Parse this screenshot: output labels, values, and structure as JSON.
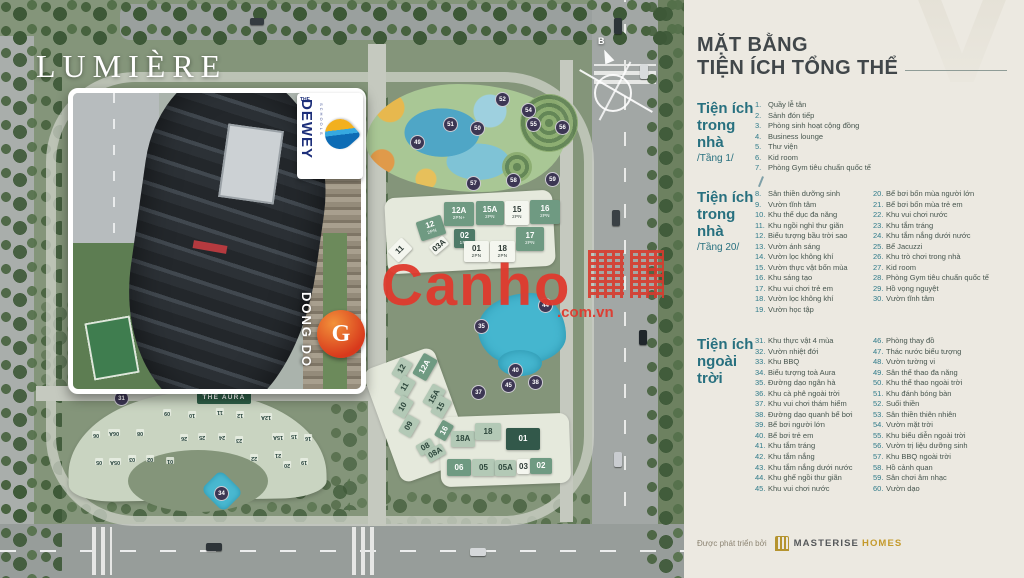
{
  "project": {
    "name": "LUMIÈRE",
    "aura_label": "THE AURA",
    "compass_north": "B"
  },
  "watermark": {
    "word": "Canho",
    "suffix": ".com.vn"
  },
  "inset": {
    "dewey_the": "THE",
    "dewey_word": "DEWEY",
    "dewey_sub": "SCHOOLS",
    "dongdo_word": "DONG DO",
    "dongdo_letter": "G"
  },
  "colors": {
    "accent_teal": "#27707F",
    "legend_text": "#47564F",
    "masterise_gold": "#C49A2C",
    "watermark_red": "#E03A2E",
    "marker_bg": "#3C3653"
  },
  "panel": {
    "title_line1": "MẶT BẰNG",
    "title_line2": "TIỆN ÍCH TỔNG THỂ"
  },
  "legend": {
    "s1": {
      "header": [
        "Tiện ích",
        "trong nhà",
        "/Tầng 1/"
      ],
      "items": [
        {
          "n": "1.",
          "t": "Quầy lễ tân"
        },
        {
          "n": "2.",
          "t": "Sảnh đón tiếp"
        },
        {
          "n": "3.",
          "t": "Phòng sinh hoạt cộng đồng"
        },
        {
          "n": "4.",
          "t": "Business lounge"
        },
        {
          "n": "5.",
          "t": "Thư viện"
        },
        {
          "n": "6.",
          "t": "Kid room"
        },
        {
          "n": "7.",
          "t": "Phòng Gym tiêu chuẩn quốc tế"
        }
      ]
    },
    "s2": {
      "header": [
        "Tiện ích",
        "trong nhà",
        "/Tầng 20/"
      ],
      "colA": [
        {
          "n": "8.",
          "t": "Sân thiền dưỡng sinh"
        },
        {
          "n": "9.",
          "t": "Vườn tĩnh tâm"
        },
        {
          "n": "10.",
          "t": "Khu thể dục đa năng"
        },
        {
          "n": "11.",
          "t": "Khu ngồi nghỉ thư giãn"
        },
        {
          "n": "12.",
          "t": "Biểu tượng bầu trời sao"
        },
        {
          "n": "13.",
          "t": "Vườn ánh sáng"
        },
        {
          "n": "14.",
          "t": "Vườn lọc không khí"
        },
        {
          "n": "15.",
          "t": "Vườn thực vật bốn mùa"
        },
        {
          "n": "16.",
          "t": "Khu sáng tạo"
        },
        {
          "n": "17.",
          "t": "Khu vui chơi trẻ em"
        },
        {
          "n": "18.",
          "t": "Vườn lọc không khí"
        },
        {
          "n": "19.",
          "t": "Vườn học tập"
        }
      ],
      "colB": [
        {
          "n": "20.",
          "t": "Bể bơi bốn mùa người lớn"
        },
        {
          "n": "21.",
          "t": "Bể bơi bốn mùa trẻ em"
        },
        {
          "n": "22.",
          "t": "Khu vui chơi nước"
        },
        {
          "n": "23.",
          "t": "Khu tắm tráng"
        },
        {
          "n": "24.",
          "t": "Khu tắm nắng dưới nước"
        },
        {
          "n": "25.",
          "t": "Bể Jacuzzi"
        },
        {
          "n": "26.",
          "t": "Khu trò chơi trong nhà"
        },
        {
          "n": "27.",
          "t": "Kid room"
        },
        {
          "n": "28.",
          "t": "Phòng Gym tiêu chuẩn quốc tế"
        },
        {
          "n": "29.",
          "t": "Hồ vọng nguyệt"
        },
        {
          "n": "30.",
          "t": "Vườn tĩnh tâm"
        }
      ]
    },
    "s3": {
      "header": [
        "Tiện ích",
        "ngoài trời"
      ],
      "colA": [
        {
          "n": "31.",
          "t": "Khu thực vật 4 mùa"
        },
        {
          "n": "32.",
          "t": "Vườn nhiệt đới"
        },
        {
          "n": "33.",
          "t": "Khu BBQ"
        },
        {
          "n": "34.",
          "t": "Biểu tượng toà Aura"
        },
        {
          "n": "35.",
          "t": "Đường dạo ngân hà"
        },
        {
          "n": "36.",
          "t": "Khu cà phê ngoài trời"
        },
        {
          "n": "37.",
          "t": "Khu vui chơi thám hiểm"
        },
        {
          "n": "38.",
          "t": "Đường dạo quanh bể bơi"
        },
        {
          "n": "39.",
          "t": "Bể bơi người lớn"
        },
        {
          "n": "40.",
          "t": "Bể bơi trẻ em"
        },
        {
          "n": "41.",
          "t": "Khu tắm tráng"
        },
        {
          "n": "42.",
          "t": "Khu tắm nắng"
        },
        {
          "n": "43.",
          "t": "Khu tắm nắng dưới nước"
        },
        {
          "n": "44.",
          "t": "Khu ghế ngồi thư giãn"
        },
        {
          "n": "45.",
          "t": "Khu vui chơi nước"
        }
      ],
      "colB": [
        {
          "n": "46.",
          "t": "Phòng thay đồ"
        },
        {
          "n": "47.",
          "t": "Thác nước biểu tượng"
        },
        {
          "n": "48.",
          "t": "Vườn tường vi"
        },
        {
          "n": "49.",
          "t": "Sân thể thao đa năng"
        },
        {
          "n": "50.",
          "t": "Khu thể thao ngoài trời"
        },
        {
          "n": "51.",
          "t": "Khu đánh bóng bàn"
        },
        {
          "n": "52.",
          "t": "Suối thiền"
        },
        {
          "n": "53.",
          "t": "Sân thiền thiên nhiên"
        },
        {
          "n": "54.",
          "t": "Vườn mặt trời"
        },
        {
          "n": "55.",
          "t": "Khu biểu diễn ngoài trời"
        },
        {
          "n": "56.",
          "t": "Vườn trị liệu dưỡng sinh"
        },
        {
          "n": "57.",
          "t": "Khu BBQ ngoài trời"
        },
        {
          "n": "58.",
          "t": "Hồ cảnh quan"
        },
        {
          "n": "59.",
          "t": "Sân chơi âm nhạc"
        },
        {
          "n": "60.",
          "t": "Vườn dạo"
        }
      ]
    }
  },
  "footer": {
    "prefix": "Được phát triển bởi",
    "brand": "MASTERISE",
    "brand2": "HOMES"
  },
  "map": {
    "north_blocks": [
      {
        "t": "12",
        "s": "2PN",
        "x": 418,
        "y": 218,
        "w": 26,
        "h": 20,
        "r": -18,
        "cls": "g1"
      },
      {
        "t": "12A",
        "s": "2PN+",
        "x": 444,
        "y": 202,
        "w": 30,
        "h": 24,
        "cls": "g1"
      },
      {
        "t": "15A",
        "s": "2PN",
        "x": 476,
        "y": 201,
        "w": 28,
        "h": 24,
        "cls": "g1"
      },
      {
        "t": "15",
        "s": "2PN",
        "x": 505,
        "y": 201,
        "w": 24,
        "h": 24,
        "cls": "w"
      },
      {
        "t": "16",
        "s": "2PN",
        "x": 530,
        "y": 200,
        "w": 30,
        "h": 24,
        "cls": "g1"
      },
      {
        "t": "11",
        "s": "",
        "x": 390,
        "y": 242,
        "w": 20,
        "h": 16,
        "r": -45,
        "cls": "w"
      },
      {
        "t": "03A",
        "s": "",
        "x": 430,
        "y": 240,
        "w": 18,
        "h": 11,
        "r": -40,
        "cls": "w"
      },
      {
        "t": "02",
        "s": "1PN",
        "x": 454,
        "y": 229,
        "w": 21,
        "h": 19,
        "cls": "g3"
      },
      {
        "t": "01",
        "s": "2PN",
        "x": 464,
        "y": 241,
        "w": 25,
        "h": 21,
        "cls": "w"
      },
      {
        "t": "18",
        "s": "2PN",
        "x": 490,
        "y": 241,
        "w": 25,
        "h": 21,
        "cls": "w"
      },
      {
        "t": "17",
        "s": "2PN",
        "x": 516,
        "y": 227,
        "w": 28,
        "h": 24,
        "cls": "g1"
      }
    ],
    "south_blocks": [
      {
        "t": "12",
        "x": 392,
        "y": 362,
        "w": 20,
        "h": 14,
        "r": -60,
        "cls": "g2"
      },
      {
        "t": "12A",
        "x": 413,
        "y": 359,
        "w": 24,
        "h": 16,
        "r": -60,
        "cls": "g1"
      },
      {
        "t": "11",
        "x": 395,
        "y": 380,
        "w": 20,
        "h": 14,
        "r": -60,
        "cls": "g2"
      },
      {
        "t": "15A",
        "x": 423,
        "y": 389,
        "w": 22,
        "h": 15,
        "r": -60,
        "cls": "g2"
      },
      {
        "t": "15",
        "x": 431,
        "y": 400,
        "w": 20,
        "h": 14,
        "r": -60,
        "cls": "g2"
      },
      {
        "t": "10",
        "x": 393,
        "y": 400,
        "w": 20,
        "h": 14,
        "r": -60,
        "cls": "g2"
      },
      {
        "t": "09",
        "x": 399,
        "y": 419,
        "w": 20,
        "h": 14,
        "r": -60,
        "cls": "g2"
      },
      {
        "t": "16",
        "x": 435,
        "y": 424,
        "w": 18,
        "h": 13,
        "r": -60,
        "cls": "g1"
      },
      {
        "t": "18A",
        "x": 451,
        "y": 431,
        "w": 24,
        "h": 16,
        "cls": "g2"
      },
      {
        "t": "18",
        "x": 475,
        "y": 423,
        "w": 26,
        "h": 17,
        "cls": "g2"
      },
      {
        "t": "01",
        "x": 506,
        "y": 428,
        "w": 34,
        "h": 22,
        "cls": "d"
      },
      {
        "t": "08",
        "x": 417,
        "y": 441,
        "w": 17,
        "h": 12,
        "r": -30,
        "cls": "g2"
      },
      {
        "t": "08A",
        "x": 426,
        "y": 447,
        "w": 19,
        "h": 12,
        "r": -30,
        "cls": "g2"
      },
      {
        "t": "06",
        "x": 447,
        "y": 459,
        "w": 24,
        "h": 17,
        "cls": "g1"
      },
      {
        "t": "05",
        "x": 472,
        "y": 459,
        "w": 23,
        "h": 17,
        "cls": "g2"
      },
      {
        "t": "05A",
        "x": 495,
        "y": 460,
        "w": 21,
        "h": 16,
        "cls": "g2"
      },
      {
        "t": "03",
        "x": 517,
        "y": 459,
        "w": 13,
        "h": 15,
        "cls": "w"
      },
      {
        "t": "02",
        "x": 530,
        "y": 458,
        "w": 22,
        "h": 16,
        "cls": "g1"
      }
    ],
    "aura_units": [
      {
        "t": "09",
        "x": 163,
        "y": 409,
        "r": 180
      },
      {
        "t": "10",
        "x": 188,
        "y": 411,
        "r": 180
      },
      {
        "t": "11",
        "x": 216,
        "y": 408,
        "r": 180
      },
      {
        "t": "12",
        "x": 236,
        "y": 411,
        "r": 180
      },
      {
        "t": "12A",
        "x": 260,
        "y": 413,
        "r": 180
      },
      {
        "t": "06",
        "x": 92,
        "y": 431,
        "r": 180
      },
      {
        "t": "06A",
        "x": 108,
        "y": 429,
        "r": 180
      },
      {
        "t": "08",
        "x": 136,
        "y": 429,
        "r": 180
      },
      {
        "t": "26",
        "x": 180,
        "y": 434,
        "r": 180
      },
      {
        "t": "25",
        "x": 198,
        "y": 433,
        "r": 180
      },
      {
        "t": "24",
        "x": 218,
        "y": 433,
        "r": 180
      },
      {
        "t": "23",
        "x": 235,
        "y": 436,
        "r": 180
      },
      {
        "t": "15A",
        "x": 272,
        "y": 433,
        "r": 180
      },
      {
        "t": "15",
        "x": 290,
        "y": 432,
        "r": 180
      },
      {
        "t": "16",
        "x": 304,
        "y": 434,
        "r": 180
      },
      {
        "t": "05",
        "x": 95,
        "y": 458,
        "r": 180
      },
      {
        "t": "05A",
        "x": 109,
        "y": 458,
        "r": 180
      },
      {
        "t": "03",
        "x": 128,
        "y": 455,
        "r": 180
      },
      {
        "t": "02",
        "x": 146,
        "y": 455,
        "r": 180
      },
      {
        "t": "01",
        "x": 166,
        "y": 457,
        "r": 180
      },
      {
        "t": "22",
        "x": 250,
        "y": 454,
        "r": 180
      },
      {
        "t": "21",
        "x": 274,
        "y": 451,
        "r": 180
      },
      {
        "t": "20",
        "x": 283,
        "y": 461,
        "r": 180
      },
      {
        "t": "19",
        "x": 300,
        "y": 458,
        "r": 180
      }
    ],
    "amenity_circles": [
      {
        "n": "49",
        "x": 417,
        "y": 142
      },
      {
        "n": "51",
        "x": 450,
        "y": 124
      },
      {
        "n": "50",
        "x": 477,
        "y": 128
      },
      {
        "n": "52",
        "x": 502,
        "y": 99
      },
      {
        "n": "54",
        "x": 528,
        "y": 110
      },
      {
        "n": "55",
        "x": 533,
        "y": 124
      },
      {
        "n": "56",
        "x": 562,
        "y": 127
      },
      {
        "n": "57",
        "x": 473,
        "y": 183
      },
      {
        "n": "58",
        "x": 513,
        "y": 180
      },
      {
        "n": "59",
        "x": 552,
        "y": 179
      },
      {
        "n": "35",
        "x": 481,
        "y": 326
      },
      {
        "n": "44",
        "x": 545,
        "y": 305
      },
      {
        "n": "37",
        "x": 478,
        "y": 392
      },
      {
        "n": "38",
        "x": 535,
        "y": 382
      },
      {
        "n": "40",
        "x": 515,
        "y": 370
      },
      {
        "n": "45",
        "x": 508,
        "y": 385
      },
      {
        "n": "31",
        "x": 121,
        "y": 398
      },
      {
        "n": "34",
        "x": 221,
        "y": 493
      }
    ]
  }
}
